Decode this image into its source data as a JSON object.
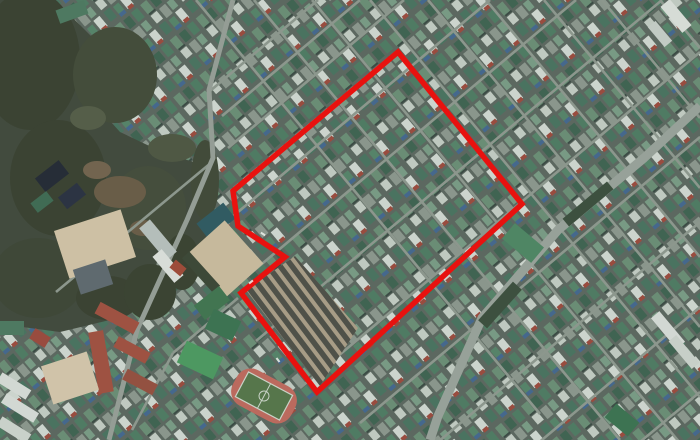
{
  "meta": {
    "kind": "aerial-satellite-photo-with-redevelopment-district-boundary",
    "width": 700,
    "height": 440
  },
  "palette": {
    "base": "#57635a",
    "road_minor": "#8f998e",
    "road_left": "#97a096",
    "road_major": "#9aa49a",
    "forest": "#41493a",
    "haze": "#6b7a8c",
    "boundary_red": "#e8120f",
    "tick_white": "#e8ece6"
  },
  "city": {
    "tile": {
      "w": 46,
      "h": 34,
      "angle": 50,
      "bg": "#5c685e",
      "houses": [
        [
          2,
          2,
          12,
          8,
          "#4f7c61"
        ],
        [
          17,
          3,
          10,
          7,
          "#7a9c84"
        ],
        [
          30,
          2,
          13,
          8,
          "#d2dad1"
        ],
        [
          3,
          13,
          11,
          8,
          "#3f6450"
        ],
        [
          17,
          12,
          12,
          8,
          "#8d988d"
        ],
        [
          32,
          13,
          11,
          7,
          "#568468"
        ],
        [
          2,
          24,
          12,
          8,
          "#6b8f74"
        ],
        [
          17,
          23,
          10,
          8,
          "#c4cec3"
        ],
        [
          30,
          23,
          12,
          8,
          "#49735e"
        ],
        [
          41,
          3,
          4,
          6,
          "#9c4a3c"
        ],
        [
          41,
          13,
          4,
          7,
          "#44688e"
        ],
        [
          14,
          23,
          2,
          8,
          "#3a4a42"
        ]
      ]
    }
  },
  "roads": {
    "minor_width": 2.6,
    "family_a": [
      [
        196,
        0,
        540,
        414
      ],
      [
        254,
        0,
        620,
        440
      ],
      [
        312,
        0,
        680,
        443
      ],
      [
        370,
        0,
        700,
        397
      ],
      [
        428,
        0,
        700,
        327
      ],
      [
        486,
        0,
        700,
        257
      ],
      [
        544,
        0,
        700,
        188
      ],
      [
        602,
        0,
        700,
        118
      ],
      [
        660,
        0,
        700,
        48
      ]
    ],
    "family_b": [
      [
        318,
        0,
        210,
        91
      ],
      [
        360,
        0,
        222,
        116
      ],
      [
        404,
        0,
        228,
        148
      ],
      [
        490,
        0,
        232,
        217
      ],
      [
        576,
        0,
        238,
        284
      ],
      [
        662,
        0,
        256,
        341
      ],
      [
        700,
        52,
        300,
        388
      ],
      [
        700,
        137,
        360,
        423
      ],
      [
        700,
        222,
        432,
        447
      ],
      [
        700,
        307,
        530,
        450
      ],
      [
        700,
        392,
        640,
        442
      ]
    ],
    "post_forest_minor": [
      [
        238,
        298,
        173,
        353
      ],
      [
        173,
        353,
        132,
        430
      ],
      [
        212,
        162,
        56,
        292
      ]
    ],
    "left_road": {
      "width": 5,
      "points": [
        [
          233,
          0
        ],
        [
          209,
          90
        ],
        [
          213,
          158
        ],
        [
          187,
          220
        ],
        [
          137,
          330
        ],
        [
          109,
          440
        ]
      ]
    },
    "major": {
      "width": 9,
      "points": [
        [
          700,
          106
        ],
        [
          644,
          158
        ],
        [
          558,
          230
        ],
        [
          482,
          318
        ],
        [
          438,
          416
        ],
        [
          430,
          440
        ]
      ]
    }
  },
  "forest": {
    "points": [
      [
        55,
        0
      ],
      [
        100,
        45
      ],
      [
        82,
        90
      ],
      [
        120,
        132
      ],
      [
        162,
        152
      ],
      [
        206,
        166
      ],
      [
        213,
        232
      ],
      [
        204,
        252
      ],
      [
        158,
        256
      ],
      [
        150,
        300
      ],
      [
        118,
        318
      ],
      [
        60,
        332
      ],
      [
        0,
        324
      ],
      [
        0,
        0
      ]
    ],
    "blobs": [
      [
        30,
        60,
        50,
        70,
        "#39412f"
      ],
      [
        115,
        75,
        42,
        48,
        "#434b37"
      ],
      [
        58,
        178,
        48,
        58,
        "#39412f"
      ],
      [
        148,
        208,
        38,
        42,
        "#444c39"
      ],
      [
        38,
        278,
        46,
        40,
        "#3e4634"
      ],
      [
        108,
        298,
        32,
        22,
        "#39412f"
      ],
      [
        172,
        148,
        24,
        14,
        "#4e5741"
      ],
      [
        88,
        118,
        18,
        12,
        "#555d46"
      ],
      [
        120,
        192,
        26,
        16,
        "#6a5c45"
      ],
      [
        97,
        170,
        14,
        9,
        "#73644c"
      ],
      [
        143,
        228,
        13,
        8,
        "#6a5c45"
      ],
      [
        150,
        292,
        26,
        28,
        "#39422f"
      ],
      [
        182,
        262,
        18,
        28,
        "#39422f"
      ],
      [
        205,
        180,
        14,
        40,
        "#414936"
      ]
    ]
  },
  "landmarks": [
    [
      "temple-roof-a",
      52,
      176,
      30,
      17,
      -38,
      "#232a33"
    ],
    [
      "temple-roof-b",
      72,
      196,
      24,
      15,
      -38,
      "#2a3140"
    ],
    [
      "temple-green-annex",
      42,
      202,
      20,
      12,
      -38,
      "#3f6b52"
    ],
    [
      "upper-schoolyard",
      95,
      244,
      70,
      50,
      -18,
      "#d3c5a6"
    ],
    [
      "gray-gym",
      93,
      277,
      34,
      26,
      -18,
      "#5f6a6e"
    ],
    [
      "campus-building-a",
      158,
      240,
      42,
      14,
      50,
      "#b9c2bd"
    ],
    [
      "campus-building-b",
      168,
      266,
      34,
      12,
      50,
      "#dfe3dd"
    ],
    [
      "campus-red-roof",
      178,
      268,
      14,
      10,
      40,
      "#a14a36"
    ],
    [
      "tennis-courts",
      216,
      221,
      34,
      20,
      -38,
      "#2f5a60"
    ],
    [
      "school-track-field",
      224,
      260,
      54,
      58,
      -42,
      "#ccbd9d"
    ],
    [
      "field-tree-line",
      201,
      272,
      10,
      46,
      -42,
      "#3c4734"
    ],
    [
      "south-green-court",
      212,
      303,
      32,
      18,
      -38,
      "#41754f"
    ],
    [
      "brick-school-wing-a",
      101,
      362,
      15,
      62,
      -10,
      "#a2513f"
    ],
    [
      "brick-school-wing-b",
      117,
      318,
      44,
      13,
      28,
      "#a2513f"
    ],
    [
      "brick-school-wing-c",
      132,
      350,
      36,
      12,
      28,
      "#a2513f"
    ],
    [
      "brick-school-wing-d",
      140,
      382,
      34,
      12,
      28,
      "#96503e"
    ],
    [
      "lower-schoolyard",
      70,
      378,
      48,
      40,
      -18,
      "#d6c8ab"
    ],
    [
      "green-roof-hall",
      200,
      360,
      40,
      24,
      25,
      "#4c9a5f"
    ],
    [
      "green-courts",
      223,
      325,
      30,
      22,
      25,
      "#3c7350"
    ],
    [
      "apartment-bar-a",
      14,
      386,
      34,
      11,
      32,
      "#d9ded7"
    ],
    [
      "apartment-bar-b",
      20,
      408,
      38,
      11,
      32,
      "#d9ded7"
    ],
    [
      "apartment-bar-c",
      14,
      430,
      34,
      11,
      32,
      "#cfd6ce"
    ],
    [
      "red-roof-house",
      40,
      338,
      18,
      12,
      32,
      "#9c4a3c"
    ],
    [
      "green-building",
      12,
      328,
      24,
      14,
      0,
      "#4d7a5f"
    ],
    [
      "big-green-roof",
      523,
      243,
      38,
      20,
      40,
      "#4e8763"
    ],
    [
      "roadside-trees-a",
      500,
      305,
      52,
      12,
      -48,
      "#3c4f3c"
    ],
    [
      "roadside-trees-b",
      588,
      204,
      58,
      10,
      -40,
      "#3c4f3c"
    ],
    [
      "white-apartment-a",
      668,
      330,
      40,
      11,
      50,
      "#d9ded7"
    ],
    [
      "white-apartment-b",
      684,
      352,
      36,
      10,
      50,
      "#cdd4cc"
    ],
    [
      "bottom-green-court",
      622,
      420,
      30,
      18,
      40,
      "#3c7350"
    ],
    [
      "topright-white-a",
      676,
      16,
      34,
      12,
      50,
      "#dde2db"
    ],
    [
      "topright-white-b",
      660,
      34,
      26,
      10,
      50,
      "#c8d0c8"
    ],
    [
      "topleft-green-building",
      72,
      12,
      30,
      14,
      -20,
      "#4d7a5f"
    ]
  ],
  "market": {
    "quad": [
      [
        246,
        290
      ],
      [
        295,
        256
      ],
      [
        358,
        328
      ],
      [
        320,
        386
      ]
    ],
    "bg": "#ab9f86",
    "stripe": "#4e5046",
    "stripe_width": 5.5,
    "spacing": 9.5,
    "angle_deg": 53,
    "center": [
      305,
      315
    ],
    "half_len": 85,
    "count": 9
  },
  "stadium": {
    "cx": 264,
    "cy": 396,
    "rot": 28,
    "track_w": 66,
    "track_h": 40,
    "track_rx": 16,
    "track_fill": "#c06a5c",
    "pitch_w": 50,
    "pitch_h": 28,
    "pitch_fill": "#567748",
    "line": "#cfd8cb"
  },
  "boundary": {
    "stroke": "#e8120f",
    "width": 5.5,
    "points": [
      [
        398,
        52
      ],
      [
        522,
        204
      ],
      [
        317,
        392
      ],
      [
        241,
        293
      ],
      [
        285,
        257
      ],
      [
        238,
        226
      ],
      [
        233,
        191
      ]
    ]
  },
  "ticks": [
    [
      263,
      234,
      33
    ],
    [
      251,
      282,
      -39
    ],
    [
      278,
      360,
      53
    ]
  ]
}
